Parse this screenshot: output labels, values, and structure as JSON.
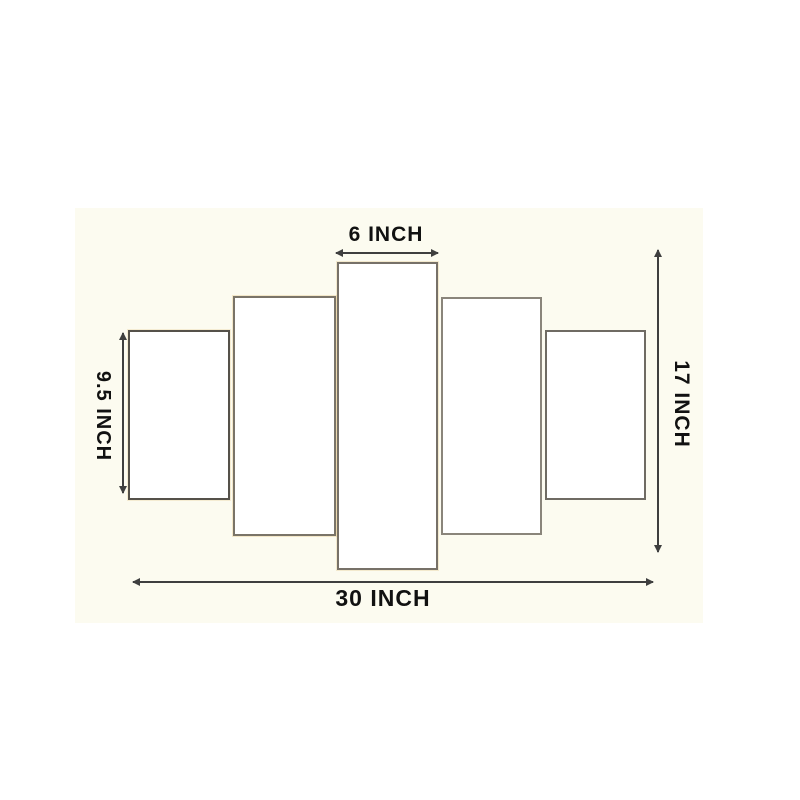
{
  "colors": {
    "page_background": "#ffffff",
    "stage_background": "#fcfbf0",
    "panel_fill": "#ffffff",
    "panel_border": "#77716a",
    "dimension_line": "#3f3f3f",
    "label_text": "#111111"
  },
  "diagram": {
    "type": "product-size-diagram",
    "panel_count": 5,
    "dimensions": {
      "top": {
        "label": "6 INCH"
      },
      "left": {
        "label": "9.5 INCH"
      },
      "right": {
        "label": "17 INCH"
      },
      "bottom": {
        "label": "30 INCH"
      }
    }
  }
}
